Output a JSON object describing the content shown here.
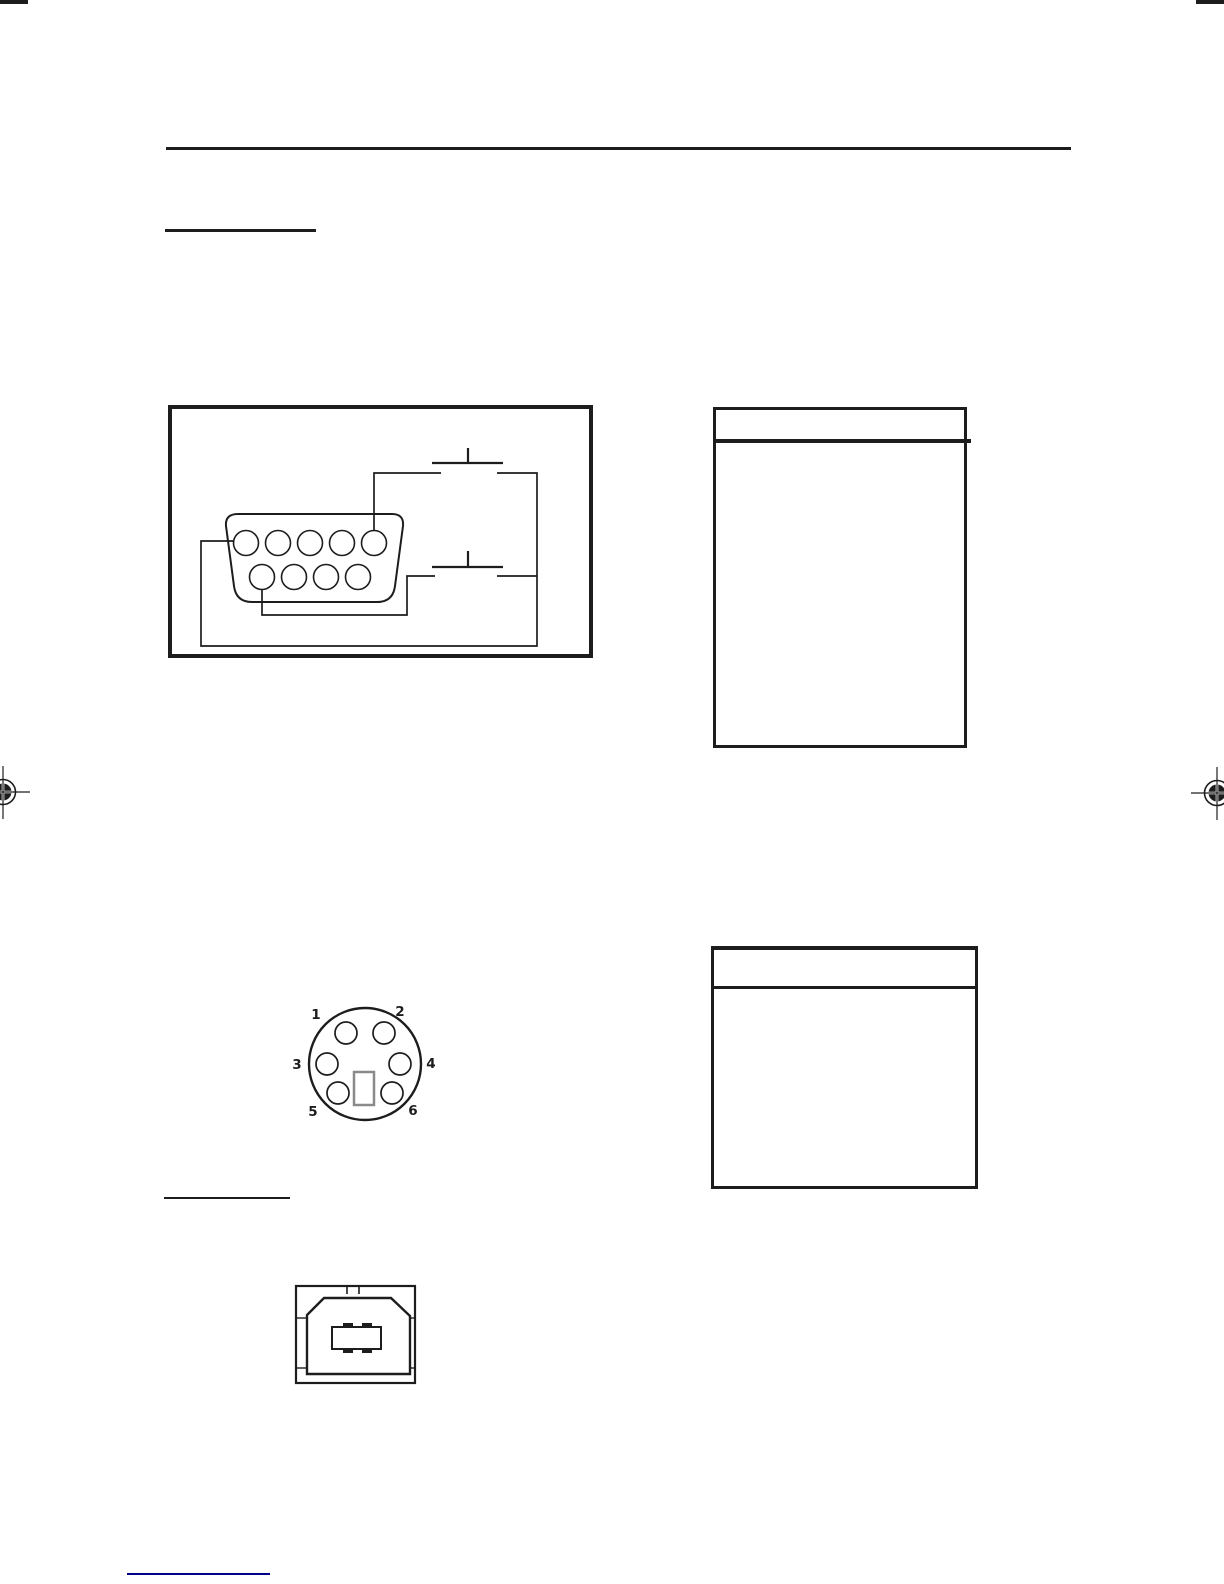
{
  "page": {
    "background": "#ffffff",
    "ink": "#1d1d1d",
    "link_color": "#000089"
  },
  "figures": {
    "serial_circuit": {
      "icon": "db9-serial-connector-footswitch-wiring-diagram",
      "pins_top_row": 5,
      "pins_bottom_row": 4,
      "switch_count": 2
    },
    "mini_din": {
      "icon": "mini-din-6-connector-front-view",
      "labels": [
        "1",
        "2",
        "3",
        "4",
        "5",
        "6"
      ],
      "key_slot_color": "#8a8a8a"
    },
    "usb": {
      "icon": "usb-type-b-connector-front-view"
    },
    "registration_mark": {
      "icon": "print-registration-crosshair-target"
    }
  },
  "tables": {
    "serial_pin_table": {
      "headers": [],
      "rows": []
    },
    "mini_din_pin_table": {
      "headers": [],
      "rows": []
    }
  }
}
